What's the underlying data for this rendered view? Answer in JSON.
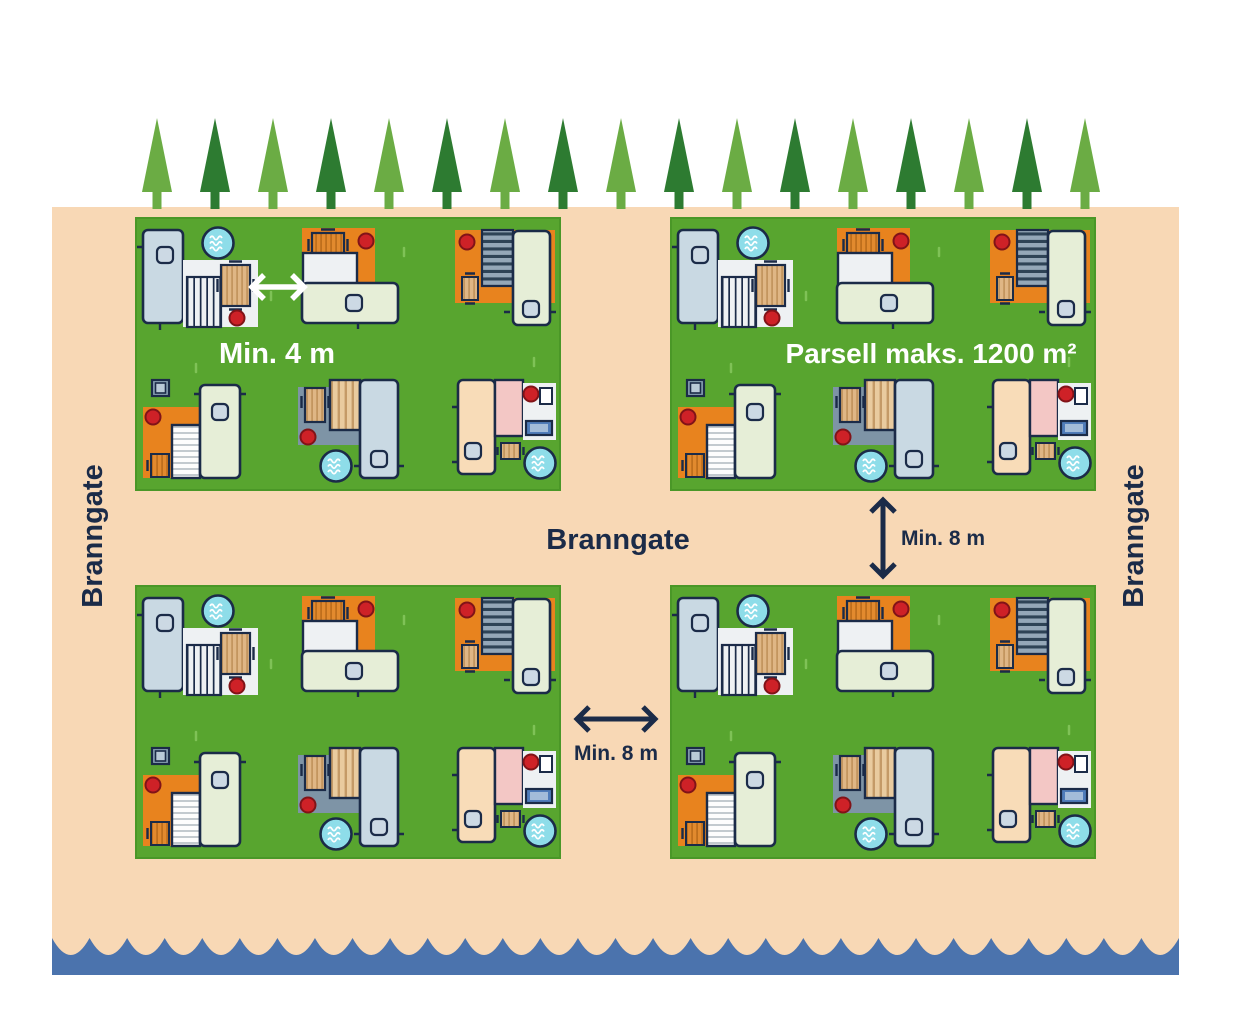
{
  "diagram": {
    "labels": {
      "fire_lane_left": "Branngate",
      "fire_lane_center": "Branngate",
      "fire_lane_right": "Branngate",
      "min_distance_units": "Min. 4 m",
      "parcel_max_area": "Parsell maks. 1200 m²",
      "min_distance_parcels_vertical": "Min. 8 m",
      "min_distance_parcels_horizontal": "Min. 8 m"
    },
    "icons": {
      "tree-icon": "conifer-triangle",
      "water-tap-icon": "circle-with-waves",
      "fire-extinguisher-icon": "red-dot",
      "wave-edge-icon": "scalloped-water-edge",
      "picnic-table-icon": "striped-wood-rect",
      "caravan-icon": "rounded-rect-with-window",
      "storage-box-icon": "nested-squares",
      "bench-icon": "nested-blue-rects"
    }
  },
  "colors": {
    "sand": "#f8d8b5",
    "grass": "#58a52f",
    "grass_edge": "#4a9727",
    "grass_tuft": "#7fc257",
    "tree_light": "#6bac44",
    "tree_dark": "#2d7b31",
    "water": "#4b73ad",
    "navy": "#1b2b48",
    "orange": "#e8831e",
    "red": "#ce2127",
    "red_dark": "#811318",
    "cyan": "#8edde9",
    "slate": "#7e94a6",
    "caravan_blue": "#c9d9e3",
    "caravan_sage": "#e6eed7",
    "caravan_peach": "#f8dcb8",
    "pink": "#f3c7c5",
    "patio_white": "#eef1f3",
    "window": "#ccd9e4",
    "wood": "#dfb685",
    "wood_dark": "#c3955f",
    "wood_orange": "#e28a2e",
    "wood_orange_dark": "#bf6f1c",
    "deck_wood_bg": "#e9cb9f",
    "deck_wood_line": "#c49a67",
    "deck_slate_bg": "#94a7b8",
    "deck_slate_line": "#2e4356",
    "awning_line": "#c3cacf",
    "box_fill": "#8aa2b4",
    "box_inner": "#b9cad7",
    "bench_blue": "#4f7cba",
    "bench_light": "#a3bcd9"
  },
  "scene": {
    "trees": {
      "count": 17,
      "start_x": 157,
      "step_x": 58,
      "base_y": 190
    },
    "waves": {
      "count": 30,
      "left": 52,
      "right": 1179,
      "crest_y": 938,
      "depth": 34,
      "bottom_y": 975
    }
  }
}
